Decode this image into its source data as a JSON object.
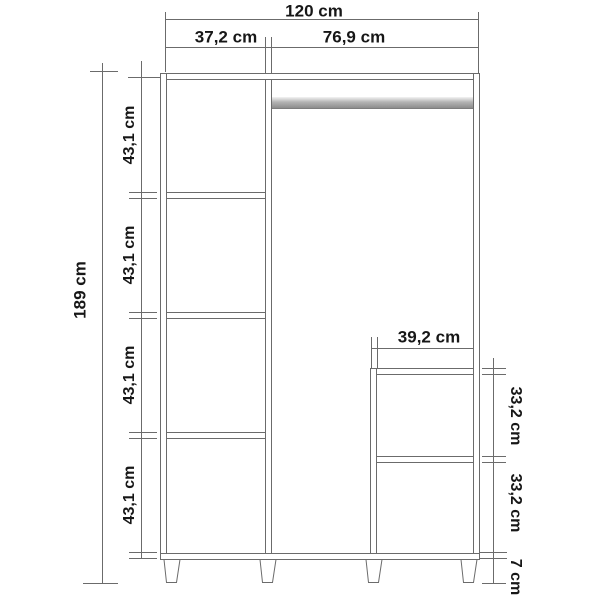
{
  "diagram": {
    "kind": "wardrobe front-view dimension drawing",
    "unit": "cm"
  },
  "labels": {
    "total_width": "120 cm",
    "left_section_width": "37,2 cm",
    "right_section_width": "76,9 cm",
    "total_height": "189 cm",
    "shelf_spacings": [
      "43,1 cm",
      "43,1 cm",
      "43,1 cm",
      "43,1 cm"
    ],
    "inner_unit_width": "39,2 cm",
    "inner_unit_compartment_heights": [
      "33,2 cm",
      "33,2 cm"
    ],
    "leg_height": "7 cm"
  },
  "values": {
    "total_width_cm": 120,
    "left_section_width_cm": 37.2,
    "right_section_width_cm": 76.9,
    "total_height_cm": 189,
    "shelf_spacing_cm": 43.1,
    "inner_unit_width_cm": 39.2,
    "inner_unit_compartment_height_cm": 33.2,
    "leg_height_cm": 7
  },
  "colors": {
    "line": "#6b6b6b",
    "text": "#171717",
    "rail_gray": "#a2a2a2",
    "background": "#ffffff"
  }
}
